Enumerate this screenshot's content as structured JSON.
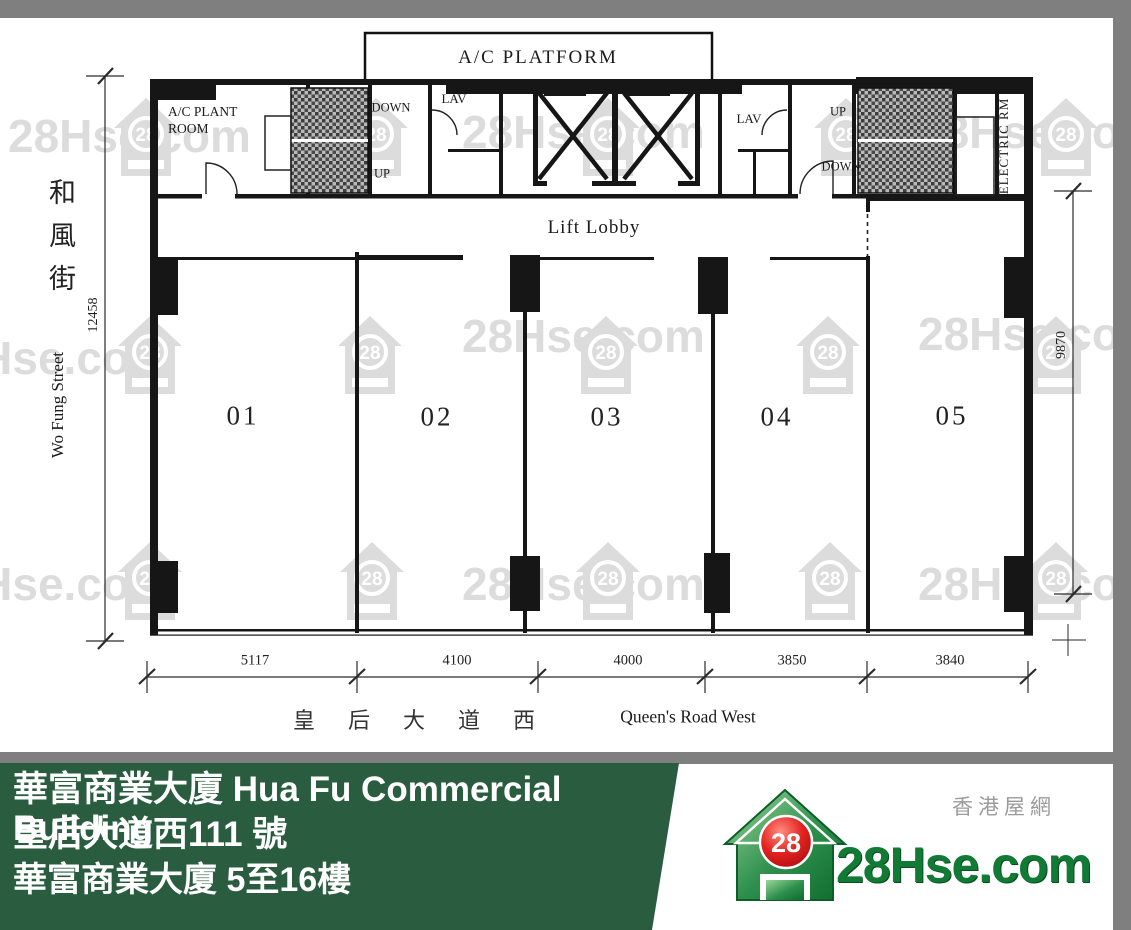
{
  "watermark": {
    "text": "28Hse.com",
    "badge": "28",
    "color": "#8f8f8f"
  },
  "plan": {
    "labels": {
      "ac_platform": "A/C PLATFORM",
      "ac_plant_line1": "A/C PLANT",
      "ac_plant_line2": "ROOM",
      "down_left": "DOWN",
      "up_left": "UP",
      "lav_left": "LAV",
      "lav_right": "LAV",
      "up_right": "UP",
      "down_right": "DOWN",
      "electric_rm": "ELECTRIC RM",
      "lift_lobby": "Lift Lobby"
    },
    "units": [
      "01",
      "02",
      "03",
      "04",
      "05"
    ],
    "dimensions": {
      "left": "12458",
      "right": "9870",
      "bottom": [
        "5117",
        "4100",
        "4000",
        "3850",
        "3840"
      ]
    },
    "streets": {
      "left_cn": "和風街",
      "left_en": "Wo Fung Street",
      "bottom_cn": "皇后大道西",
      "bottom_en": "Queen's Road West"
    }
  },
  "banner": {
    "line1": "華富商業大廈 Hua Fu Commercial Building",
    "line2": "皇后大道西111 號",
    "line3": "華富商業大廈 5至16樓",
    "bg_color": "#2a5c3f"
  },
  "logo": {
    "site_name_cn": "香港屋網",
    "brand": "28Hse.com",
    "badge": "28",
    "brand_color": "#117a35",
    "badge_color": "#d42127"
  }
}
